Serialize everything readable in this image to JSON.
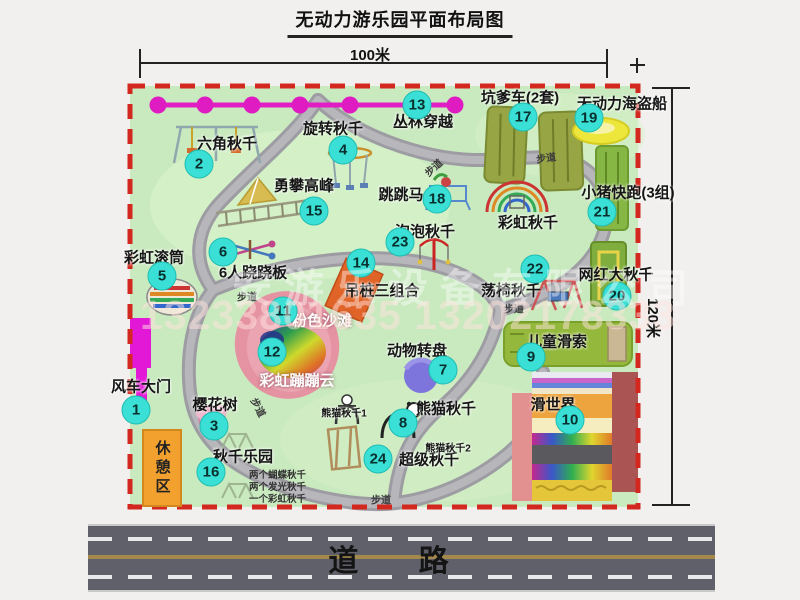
{
  "title": "无动力游乐园平面布局图",
  "dimensions": {
    "top": "100米",
    "right": "120米"
  },
  "road_label": "道 路",
  "watermark": {
    "company": "安游乐设备有限公司",
    "phone": "13233801635 13202178333"
  },
  "rest_area_label": "休憩区",
  "path_label_text": "步道",
  "colors": {
    "park_green": "#c9e9bf",
    "border_red": "#d3281f",
    "badge_cyan": "#3ae0d6",
    "zipline_magenta": "#e11ec4",
    "gate_magenta": "#e318d6",
    "rest_orange": "#f2a12f",
    "road_gray": "#60606a",
    "beach_pink": "#e593a2"
  },
  "map": {
    "features": [
      {
        "id": "windmill-gate",
        "n": "1",
        "label": "风车大门",
        "lx": 141,
        "ly": 386,
        "bx": 136,
        "by": 410
      },
      {
        "id": "hexagon-swing",
        "n": "2",
        "label": "六角秋千",
        "lx": 227,
        "ly": 143,
        "bx": 199,
        "by": 164
      },
      {
        "id": "cherry-tree",
        "n": "3",
        "label": "樱花树",
        "lx": 215,
        "ly": 404,
        "bx": 214,
        "by": 426
      },
      {
        "id": "rotary-swing",
        "n": "4",
        "label": "旋转秋千",
        "lx": 333,
        "ly": 128,
        "bx": 343,
        "by": 150
      },
      {
        "id": "rainbow-roller",
        "n": "5",
        "label": "彩虹滚筒",
        "lx": 154,
        "ly": 257,
        "bx": 162,
        "by": 276
      },
      {
        "id": "six-seesaw",
        "n": "6",
        "label": "6人跷跷板",
        "lx": 253,
        "ly": 272,
        "bx": 223,
        "by": 252
      },
      {
        "id": "animal-turntable",
        "n": "7",
        "label": "动物转盘",
        "lx": 417,
        "ly": 350,
        "bx": 443,
        "by": 370
      },
      {
        "id": "panda-swing",
        "n": "8",
        "label": "熊猫秋千",
        "lx": 446,
        "ly": 408,
        "bx": 403,
        "by": 423
      },
      {
        "id": "kids-zipline",
        "n": "9",
        "label": "儿童滑索",
        "lx": 557,
        "ly": 341,
        "bx": 531,
        "by": 357
      },
      {
        "id": "slide-world",
        "n": "10",
        "label": "滑世界",
        "lx": 553,
        "ly": 404,
        "bx": 570,
        "by": 420
      },
      {
        "id": "pink-beach",
        "n": "11",
        "label": "粉色沙滩",
        "lx": 322,
        "ly": 320,
        "bx": 283,
        "by": 311,
        "light": true
      },
      {
        "id": "rainbow-cloud",
        "n": "12",
        "label": "彩虹蹦蹦云",
        "lx": 297,
        "ly": 380,
        "bx": 272,
        "by": 352,
        "light": true
      },
      {
        "id": "jungle-crossing",
        "n": "13",
        "label": "丛林穿越",
        "lx": 423,
        "ly": 121,
        "bx": 417,
        "by": 105
      },
      {
        "id": "hanging-combo",
        "n": "14",
        "label": "吊桩三组合",
        "lx": 382,
        "ly": 290,
        "bx": 361,
        "by": 263
      },
      {
        "id": "climbing-peak",
        "n": "15",
        "label": "勇攀高峰",
        "lx": 304,
        "ly": 185,
        "bx": 314,
        "by": 211
      },
      {
        "id": "swing-park",
        "n": "16",
        "label": "秋千乐园",
        "lx": 243,
        "ly": 456,
        "bx": 211,
        "by": 472
      },
      {
        "id": "kart-track",
        "n": "17",
        "label": "坑爹车(2套)",
        "lx": 520,
        "ly": 97,
        "bx": 523,
        "by": 117
      },
      {
        "id": "jumping-horse",
        "n": "18",
        "label": "跳跳马",
        "lx": 401,
        "ly": 194,
        "bx": 437,
        "by": 199
      },
      {
        "id": "pirate-ship",
        "n": "19",
        "label": "无动力海盗船",
        "lx": 622,
        "ly": 103,
        "bx": 589,
        "by": 118
      },
      {
        "id": "big-swing",
        "n": "20",
        "label": "网红大秋千",
        "lx": 616,
        "ly": 274,
        "bx": 617,
        "by": 296
      },
      {
        "id": "piggy-run",
        "n": "21",
        "label": "小猪快跑(3组)",
        "lx": 628,
        "ly": 192,
        "bx": 602,
        "by": 212
      },
      {
        "id": "chair-swing",
        "n": "22",
        "label": "荡椅秋千",
        "lx": 511,
        "ly": 290,
        "bx": 535,
        "by": 269
      },
      {
        "id": "bubble-swing",
        "n": "23",
        "label": "泡泡秋千",
        "lx": 425,
        "ly": 231,
        "bx": 400,
        "by": 242
      },
      {
        "id": "super-swing",
        "n": "24",
        "label": "超级秋千",
        "lx": 429,
        "ly": 459,
        "bx": 378,
        "by": 459
      },
      {
        "id": "rainbow-swing",
        "n": null,
        "label": "彩虹秋千",
        "lx": 528,
        "ly": 222
      },
      {
        "id": "panda-swing-1",
        "n": null,
        "label": "熊猫秋千1",
        "lx": 344,
        "ly": 412,
        "small": true
      },
      {
        "id": "panda-swing-2",
        "n": null,
        "label": "熊猫秋千2",
        "lx": 448,
        "ly": 447,
        "small": true
      }
    ],
    "swing_park_notes": [
      "两个蝴蝶秋千",
      "两个发光秋千",
      "一个彩虹秋千"
    ],
    "path_labels": [
      {
        "x": 433,
        "y": 167,
        "r": -42
      },
      {
        "x": 546,
        "y": 157,
        "r": -8
      },
      {
        "x": 247,
        "y": 296,
        "r": 0
      },
      {
        "x": 514,
        "y": 308,
        "r": 0
      },
      {
        "x": 259,
        "y": 407,
        "r": 62
      },
      {
        "x": 381,
        "y": 499,
        "r": 0
      }
    ]
  }
}
